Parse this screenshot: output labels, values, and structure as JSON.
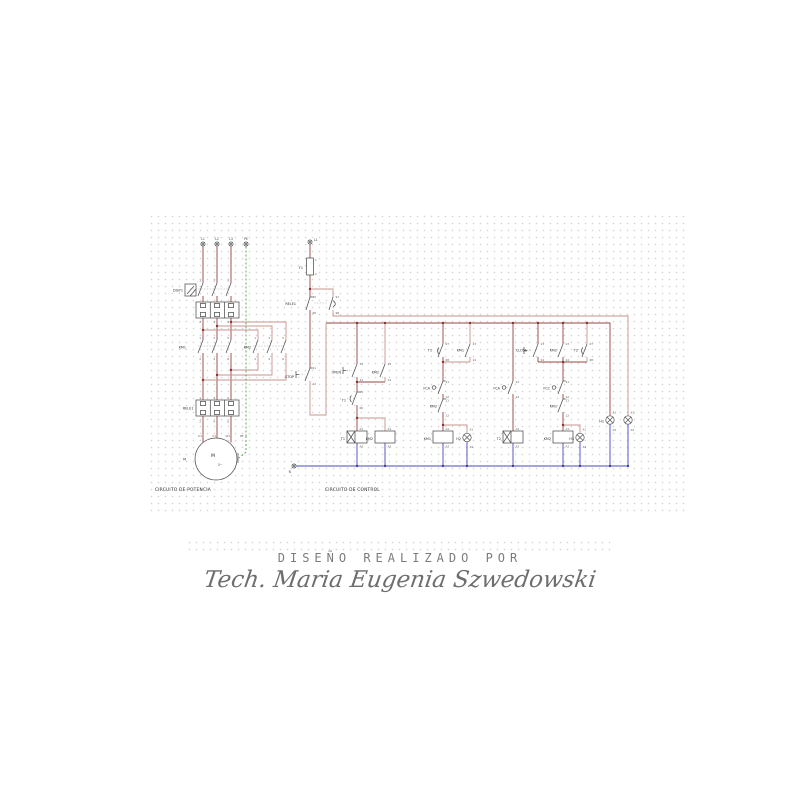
{
  "colors": {
    "live_wire": "#96443f",
    "live_wire_light": "#c9948e",
    "neutral_wire": "#4747c2",
    "ground_wire": "#46a34a",
    "component": "#4f4f4f"
  },
  "footer": {
    "credit": "DISEÑO REALIZADO POR",
    "signature": "Tech. Maria Eugenia Szwedowski"
  },
  "power": {
    "title": "CIRCUITO DE POTENCIA",
    "phases": [
      "L1",
      "L2",
      "L3",
      "PE"
    ],
    "breaker": {
      "name": "DISY1",
      "top": [
        "1",
        "3",
        "5"
      ],
      "bottom": [
        "2",
        "4",
        "6"
      ]
    },
    "km1": {
      "name": "KM1",
      "top": [
        "1",
        "3",
        "5"
      ],
      "bottom": [
        "2",
        "4",
        "6"
      ]
    },
    "km2": {
      "name": "KM2",
      "top": [
        "1",
        "3",
        "5"
      ],
      "bottom": [
        "2",
        "4",
        "6"
      ]
    },
    "rele": {
      "name": "RELE1",
      "top": [
        "1",
        "3",
        "5"
      ],
      "bottom": [
        "2",
        "4",
        "6"
      ]
    },
    "motor": {
      "name": "M",
      "inside": "M",
      "type": "3~",
      "terminals": [
        "U1",
        "V1",
        "W1",
        "PE"
      ]
    }
  },
  "control": {
    "title": "CIRCUITO DE CONTROL",
    "line_terminal": "L1",
    "neutral_terminal": "N",
    "fuse": {
      "name": "F1",
      "top": "1",
      "bottom": "2"
    },
    "rele_contact": {
      "name": "RELE1",
      "nc_top": "95",
      "nc_bottom": "96",
      "no_top": "97",
      "no_bottom": "98"
    },
    "stop": {
      "name": "STOP",
      "top": "11",
      "bottom": "12"
    },
    "open_branch": {
      "open_button": {
        "name": "OPEN",
        "top": "13",
        "bottom": "14"
      },
      "km2_aux": {
        "name": "KM2",
        "top": "13",
        "bottom": "14"
      },
      "t1_nc": {
        "name": "T1",
        "top": "65",
        "bottom": "66"
      },
      "t1_coil": {
        "name": "T1",
        "top": "A1",
        "bottom": "A2"
      },
      "km2_coil": {
        "name": "KM2",
        "top": "A1",
        "bottom": "A2"
      }
    },
    "open_contactor_branch": {
      "t1_no": {
        "name": "T1",
        "top": "67",
        "bottom": "68"
      },
      "km1_aux": {
        "name": "KM1",
        "top": "13",
        "bottom": "14"
      },
      "fca_nc": {
        "name": "FCA",
        "top": "11",
        "bottom": "12"
      },
      "km2_nc": {
        "name": "KM2",
        "top": "11",
        "bottom": "12"
      },
      "km1_coil": {
        "name": "KM1",
        "top": "A1",
        "bottom": "A2"
      },
      "h2_lamp": {
        "name": "H2",
        "top": "X1",
        "bottom": "X2"
      }
    },
    "pause_timer_branch": {
      "fca_no": {
        "name": "FCA",
        "top": "13",
        "bottom": "14"
      },
      "t2_coil": {
        "name": "T2",
        "top": "A1",
        "bottom": "A2"
      }
    },
    "close_contactor_branch": {
      "close_button": {
        "name": "CLOSE",
        "top": "13",
        "bottom": "14"
      },
      "km2_aux": {
        "name": "KM2",
        "top": "13",
        "bottom": "14"
      },
      "t2_no": {
        "name": "T2",
        "top": "67",
        "bottom": "68"
      },
      "fcc_nc": {
        "name": "FCC",
        "top": "11",
        "bottom": "12"
      },
      "km1_nc": {
        "name": "KM1",
        "top": "11",
        "bottom": "12"
      },
      "km2_coil": {
        "name": "KM2",
        "top": "A1",
        "bottom": "A2"
      },
      "h3_lamp": {
        "name": "H3",
        "top": "X1",
        "bottom": "X2"
      }
    },
    "pilot_lamps": {
      "h1_lamp": {
        "name": "H1",
        "top": "X1",
        "bottom": "X2"
      },
      "trip_lamp": {
        "top": "X1",
        "bottom": "X2"
      }
    }
  }
}
